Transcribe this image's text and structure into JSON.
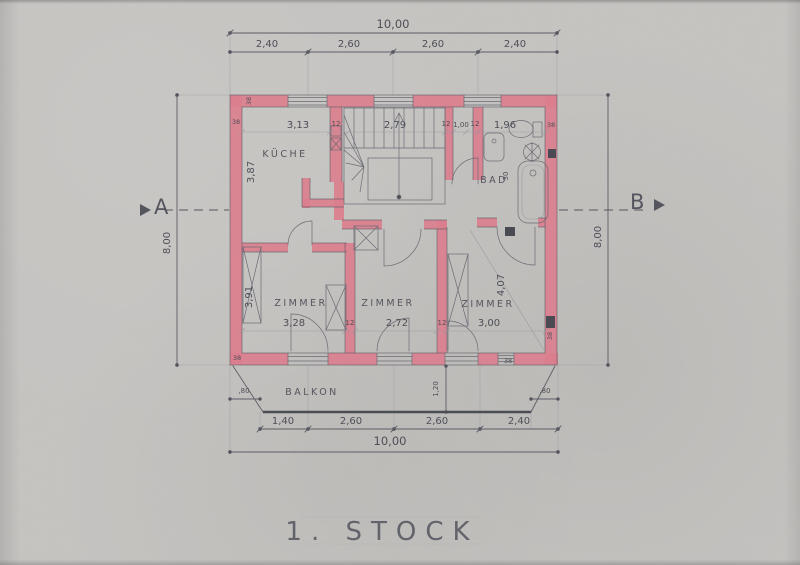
{
  "drawing_title": "1. STOCK",
  "section_markers": {
    "left": "A",
    "right": "B"
  },
  "rooms": {
    "kitchen": "KÜCHE",
    "bath": "BAD",
    "room_left": "ZIMMER",
    "room_middle": "ZIMMER",
    "room_right": "ZIMMER",
    "balcony": "BALKON"
  },
  "dims": {
    "top_total": "10,00",
    "top_segments": [
      "2,40",
      "2,60",
      "2,60",
      "2,40"
    ],
    "bottom_segments": [
      "1,40",
      "2,60",
      "2,60",
      "2,40"
    ],
    "bottom_total": "10,00",
    "height_left": "8,00",
    "height_right": "8,00",
    "interior_top": [
      "3,13",
      "12",
      "2,79",
      "12",
      "1,00",
      "12",
      "1,96",
      "38"
    ],
    "interior_bottom": [
      "3,28",
      "12",
      "2,72",
      "12",
      "3,00"
    ],
    "kitchen_depth": "3,87",
    "room_left_depth": "3,91",
    "room_right_depth": "4,07",
    "bath_niche": "30",
    "balcony_depth": "1,20",
    "balcony_offsets": [
      ",80",
      ",80"
    ],
    "wall_thickness_top": "38",
    "wall_thickness_left": "38",
    "wall_thickness_bottom_left": "38",
    "wall_thickness_bottom_right": "38",
    "wall_thickness_flue": "38"
  },
  "colors": {
    "paper": "#c7c5c2",
    "wall_fill": "#db7f8e",
    "pencil": "#5d5d66",
    "dim_text": "#4e4e57"
  }
}
